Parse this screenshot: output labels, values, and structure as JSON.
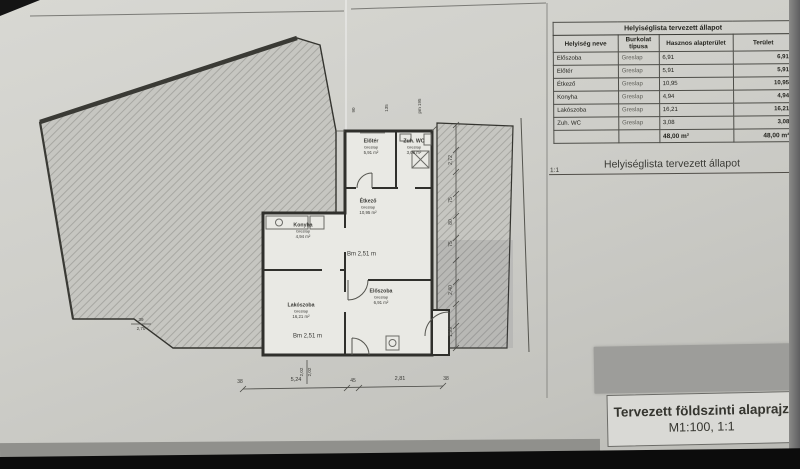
{
  "colors": {
    "paper": "#cecec9",
    "ink": "#2e2e2a",
    "hatch_line": "#a7a7a2",
    "background": "#121212"
  },
  "table": {
    "title": "Helyiséglista tervezett állapot",
    "columns": [
      "Helyiség neve",
      "Burkolat típusa",
      "Hasznos alapterület",
      "Terület"
    ],
    "rows": [
      {
        "name": "Előszoba",
        "flooring": "Greslap",
        "area": "6,91",
        "total": "6,91"
      },
      {
        "name": "Előtér",
        "flooring": "Greslap",
        "area": "5,91",
        "total": "5,91"
      },
      {
        "name": "Étkező",
        "flooring": "Greslap",
        "area": "10,95",
        "total": "10,95"
      },
      {
        "name": "Konyha",
        "flooring": "Greslap",
        "area": "4,94",
        "total": "4,94"
      },
      {
        "name": "Lakószoba",
        "flooring": "Greslap",
        "area": "16,21",
        "total": "16,21"
      },
      {
        "name": "Zuh. WC",
        "flooring": "Greslap",
        "area": "3,08",
        "total": "3,08"
      }
    ],
    "total_row": {
      "area": "48,00 m²",
      "total": "48,00 m²"
    }
  },
  "caption": {
    "scale": "1:1",
    "text": "Helyiséglista tervezett állapot"
  },
  "title_block": {
    "line1": "Tervezett földszinti alaprajz",
    "line2": "M1:100, 1:1"
  },
  "rooms": [
    {
      "name": "Előtér",
      "flooring": "Greslap",
      "area": "5,91 m²"
    },
    {
      "name": "Zuh. WC",
      "flooring": "Greslap",
      "area": "3,08 m²"
    },
    {
      "name": "Étkező",
      "flooring": "Greslap",
      "area": "10,95 m²"
    },
    {
      "name": "Konyha",
      "flooring": "Greslap",
      "area": "4,94 m²"
    },
    {
      "name": "Lakószoba",
      "flooring": "Greslap",
      "area": "16,21 m²"
    },
    {
      "name": "Előszoba",
      "flooring": "Greslap",
      "area": "6,91 m²"
    }
  ],
  "dims": {
    "bm1": "Bm 2,51 m",
    "bm2": "Bm 2,51 m",
    "bottom": [
      "38",
      "5,24",
      "45",
      "2,81",
      "38"
    ],
    "right": [
      "2,72",
      "75",
      "80",
      "75",
      "2,40",
      "1,99"
    ],
    "left_pair": [
      "39",
      "2,70"
    ],
    "mid_pair": [
      "2,02",
      "2,02"
    ],
    "top": [
      "90",
      "135",
      "pm 195"
    ]
  }
}
